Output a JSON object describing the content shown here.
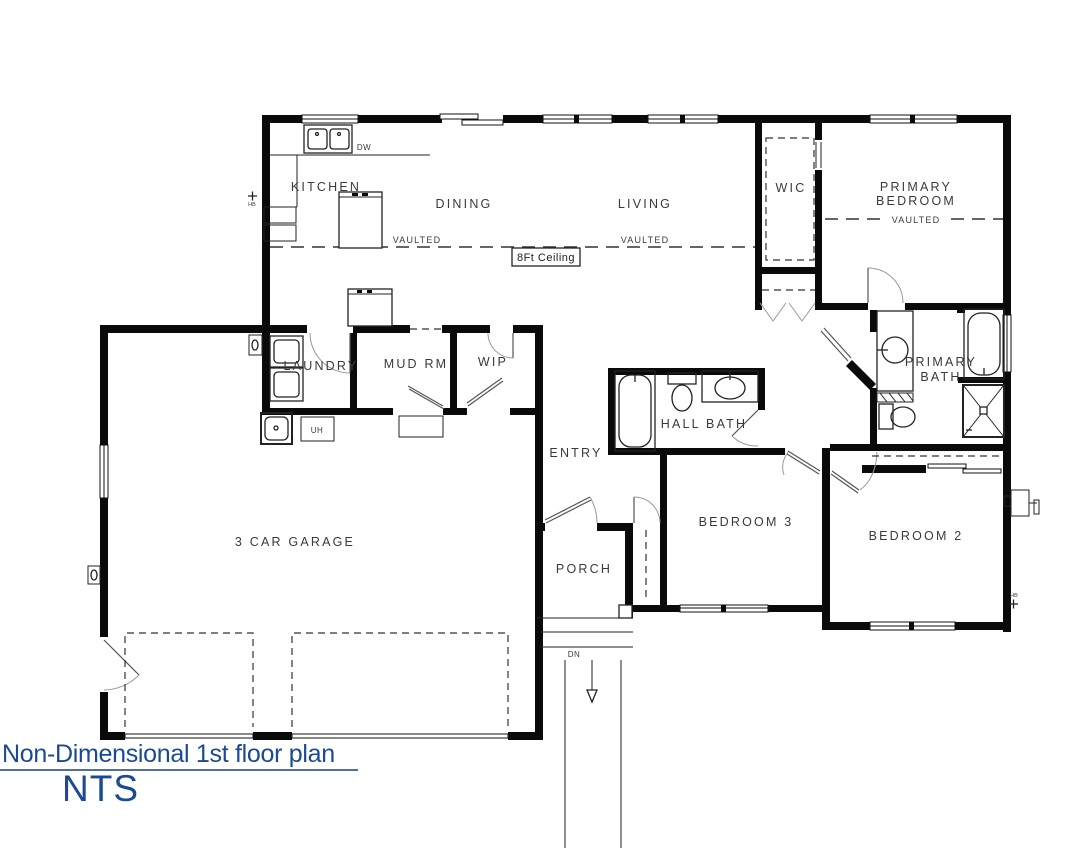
{
  "title_block": {
    "title": "Non-Dimensional 1st floor plan",
    "scale": "NTS"
  },
  "rooms": {
    "kitchen": "KITCHEN",
    "dining": "DINING",
    "living": "LIVING",
    "wic": "WIC",
    "primary_bedroom": [
      "PRIMARY",
      "BEDROOM"
    ],
    "laundry": "LAUNDRY",
    "mud_rm": "MUD RM",
    "wip": "WIP",
    "entry": "ENTRY",
    "hall_bath": "HALL BATH",
    "primary_bath": [
      "PRIMARY",
      "BATH"
    ],
    "bedroom3": "BEDROOM 3",
    "bedroom2": "BEDROOM 2",
    "garage": "3 CAR GARAGE",
    "porch": "PORCH"
  },
  "annotations": {
    "vaulted_dining": "VAULTED",
    "vaulted_living": "VAULTED",
    "vaulted_primary": "VAULTED",
    "ceiling_height": "8Ft Ceiling",
    "dishwasher": "DW",
    "unit_heater": "UH",
    "down": "DN",
    "hose_bib_left": "HB",
    "hose_bib_right": "HB"
  },
  "colors": {
    "wall": "#0a0a0a",
    "label": "#3a3a3a",
    "accent": "#1a4a94",
    "dash": "#333333",
    "fixture": "#222222"
  }
}
